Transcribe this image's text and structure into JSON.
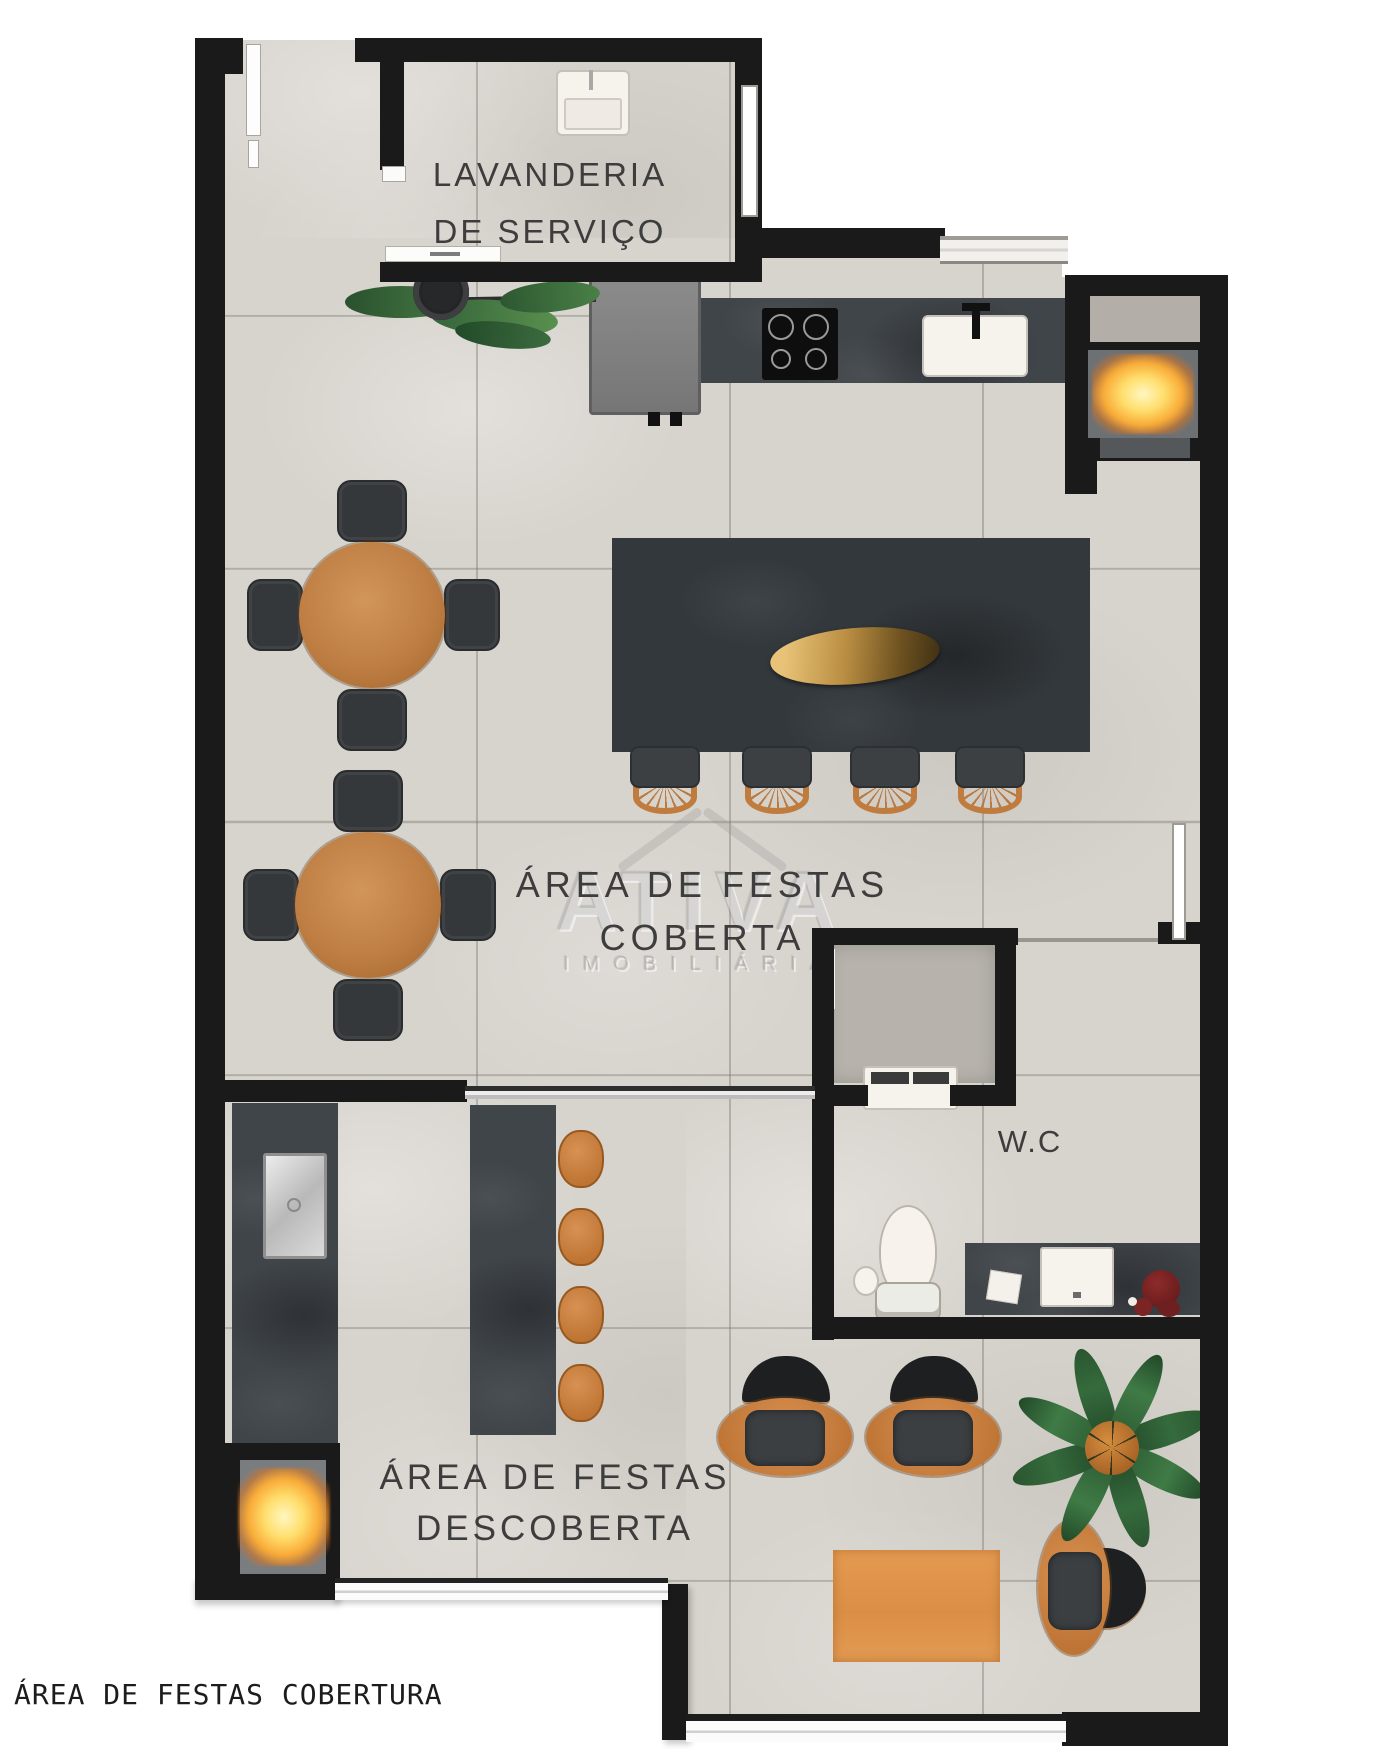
{
  "page": {
    "caption": "ÁREA DE FESTAS COBERTURA",
    "background": "#ffffff"
  },
  "labels": {
    "laundry": {
      "line1": "LAVANDERIA",
      "line2": "DE SERVIÇO"
    },
    "covered": {
      "line1": "ÁREA DE FESTAS",
      "line2": "COBERTA"
    },
    "uncovered": {
      "line1": "ÁREA DE FESTAS",
      "line2": "DESCOBERTA"
    },
    "wc": "W.C"
  },
  "watermark": {
    "brand": "ATIVA",
    "subtitle": "IMOBILIÁRIA"
  },
  "rooms": [
    "LAVANDERIA DE SERVIÇO",
    "ÁREA DE FESTAS COBERTA",
    "ÁREA DE FESTAS DESCOBERTA",
    "W.C"
  ],
  "furniture": [
    "laundry-sink",
    "kitchen-counter",
    "refrigerator",
    "cooktop",
    "kitchen-sink",
    "counter-plant",
    "barbecue-grill",
    "dining-island",
    "gold-centerpiece",
    "island-chair x4",
    "round-table x2",
    "table-chair x8",
    "shower-box",
    "shower-bench",
    "toilet",
    "toilet-paper",
    "vanity-counter",
    "vanity-sink",
    "soap-dish",
    "flower-decor",
    "side-counter",
    "steel-sink",
    "bar-counter",
    "bar-stool x4",
    "fire-pit",
    "lounge-chair x3",
    "floor-plant",
    "outdoor-rug"
  ],
  "colors": {
    "wall": "#1a1a1a",
    "floor": "#d7d3cd",
    "slate": "#3c4145",
    "wood": "#bf7f44",
    "accent_orange": "#c9823f",
    "fire": "#f9ab38",
    "plant_green": "#2f5d36",
    "rug": "#e3974e",
    "white_fixture": "#f6f2ec"
  }
}
